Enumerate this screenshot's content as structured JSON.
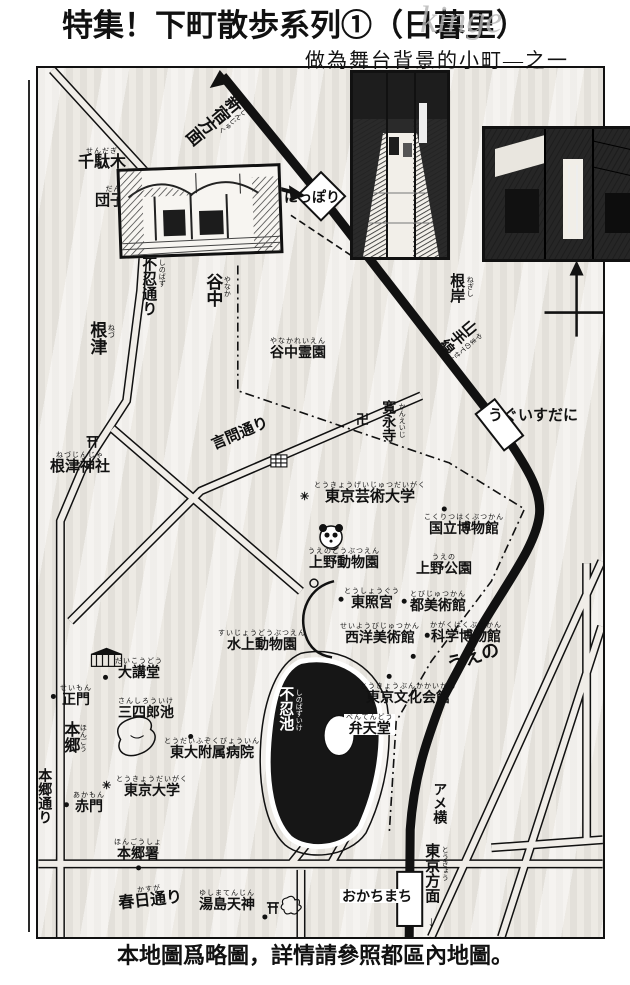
{
  "page": {
    "title": "特集！下町散歩系列①（日暮里）",
    "watermark": "kinge",
    "subtitle": "做為舞台背景的小町—之一",
    "caption": "本地圖爲略圖，詳情請參照都區內地圖。"
  },
  "colors": {
    "ink": "#111111",
    "paper": "#ffffff",
    "halftone": "#e3e0da",
    "watermark_gray": "#b5b5b5",
    "pond_black": "#161616"
  },
  "map": {
    "labels": [
      {
        "id": "sendagi",
        "text": "千駄木",
        "ruby": "せんだぎ"
      },
      {
        "id": "dangozaka",
        "text": "団子坂",
        "ruby": "だんご"
      },
      {
        "id": "yanaka",
        "text": "谷中",
        "ruby": "やなか"
      },
      {
        "id": "yanaka-reien",
        "text": "谷中霊園",
        "ruby": "やなかれいえん"
      },
      {
        "id": "negishi",
        "text": "根岸",
        "ruby": "ねぎし"
      },
      {
        "id": "nezu",
        "text": "根津",
        "ruby": "ねづ"
      },
      {
        "id": "nezu-jinja",
        "text": "根津神社",
        "ruby": "ねづじんじゃ"
      },
      {
        "id": "kaneiji",
        "text": "寛永寺",
        "ruby": "かんえいじ"
      },
      {
        "id": "geidai",
        "text": "東京芸術大学",
        "ruby": "とうきょうげいじゅつだいがく"
      },
      {
        "id": "kokuritsu-hakubutsukan",
        "text": "国立博物館",
        "ruby": "こくりつはくぶつかん"
      },
      {
        "id": "ueno-zoo",
        "text": "上野動物園",
        "ruby": "うえのどうぶつえん"
      },
      {
        "id": "ueno-park",
        "text": "上野公園",
        "ruby": "うえの"
      },
      {
        "id": "toshogu",
        "text": "東照宮",
        "ruby": "とうしょうぐう"
      },
      {
        "id": "to-bijutsukan",
        "text": "都美術館",
        "ruby": "とびじゅつかん"
      },
      {
        "id": "seiyo-bijutsukan",
        "text": "西洋美術館",
        "ruby": "せいようびじゅつかん"
      },
      {
        "id": "kagaku-hakubutsukan",
        "text": "科学博物館",
        "ruby": "かがくはくぶつかん"
      },
      {
        "id": "ueno-station-area",
        "text": "うえの",
        "ruby": ""
      },
      {
        "id": "tokyo-bunka-kaikan",
        "text": "東京文化会館",
        "ruby": "とうきょうぶんかかいかん"
      },
      {
        "id": "suijo-zoo",
        "text": "水上動物園",
        "ruby": "すいじょうどうぶつえん"
      },
      {
        "id": "daikodo",
        "text": "大講堂",
        "ruby": "だいこうどう"
      },
      {
        "id": "seimon",
        "text": "正門",
        "ruby": "せいもん"
      },
      {
        "id": "sanshiro-ike",
        "text": "三四郎池",
        "ruby": "さんしろういけ"
      },
      {
        "id": "hongo",
        "text": "本郷",
        "ruby": "ほんごう"
      },
      {
        "id": "todai-byoin",
        "text": "東大附属病院",
        "ruby": "とうだいふぞくびょういん"
      },
      {
        "id": "tokyo-daigaku",
        "text": "東京大学",
        "ruby": "とうきょうだいがく"
      },
      {
        "id": "akamon",
        "text": "赤門",
        "ruby": "あかもん"
      },
      {
        "id": "hongo-sho",
        "text": "本郷署",
        "ruby": "ほんごうしょ"
      },
      {
        "id": "shinobazu-ike",
        "text": "不忍池",
        "ruby": "しのばずいけ"
      },
      {
        "id": "bentendo",
        "text": "弁天堂",
        "ruby": "べんてんどう"
      },
      {
        "id": "ameyoko",
        "text": "アメ横",
        "ruby": ""
      },
      {
        "id": "yushima-tenjin",
        "text": "湯島天神",
        "ruby": "ゆしまてんじん"
      },
      {
        "id": "shinobazu-dori",
        "text": "不忍通り",
        "ruby": "しのばず"
      },
      {
        "id": "kototoi-dori",
        "text": "言問通り",
        "ruby": ""
      },
      {
        "id": "hongo-dori",
        "text": "本郷通り",
        "ruby": ""
      },
      {
        "id": "kasuga-dori",
        "text": "春日通り",
        "ruby": "かすが"
      },
      {
        "id": "nippori-station",
        "text": "にっぽり",
        "ruby": ""
      },
      {
        "id": "uguisudani-station",
        "text": "うぐいすだに",
        "ruby": ""
      },
      {
        "id": "okachimachi-station",
        "text": "おかちまち",
        "ruby": ""
      },
      {
        "id": "yamanote-line",
        "text": "山手線",
        "ruby": "やまのてせん"
      },
      {
        "id": "shinjuku-homen",
        "text": "新宿方面",
        "ruby": "しんじゅく"
      },
      {
        "id": "tokyo-homen",
        "text": "東京方面",
        "ruby": "とうきょう"
      }
    ],
    "markers": {
      "school_mark": "✳",
      "temple_mark": "卍",
      "down_arrow": "↓"
    }
  }
}
